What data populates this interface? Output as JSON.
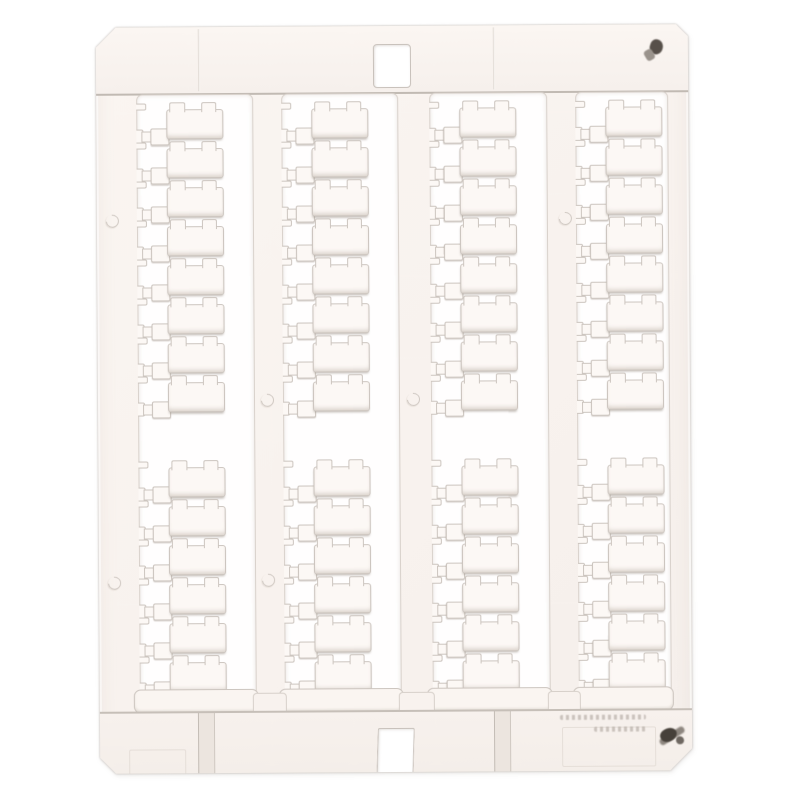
{
  "product": {
    "kind_label": "blank terminal marker tag card",
    "columns": 4,
    "rows_upper": 8,
    "rows_lower": 6,
    "tags_per_column": 14,
    "total_tags": 56,
    "mounting_hole_count": 1,
    "bottom_slot_count": 1,
    "mold_circle_count": 6
  },
  "colors": {
    "background": "#ffffff",
    "plastic": "#f8f2ee",
    "plastic_highlight": "#fcf8f5",
    "outline": "#ccc5bf",
    "band_line": "#c1bab3",
    "cutout_white": "#fffefe",
    "smudge_dark": "#4e4740",
    "smudge_gray": "#8d867f",
    "emboss_gray": "#a89f98"
  },
  "marks": {
    "top_right_smudge": true,
    "bottom_right_smudge": true,
    "embossed_text_legible": false,
    "embossed_text_lines": 2
  }
}
